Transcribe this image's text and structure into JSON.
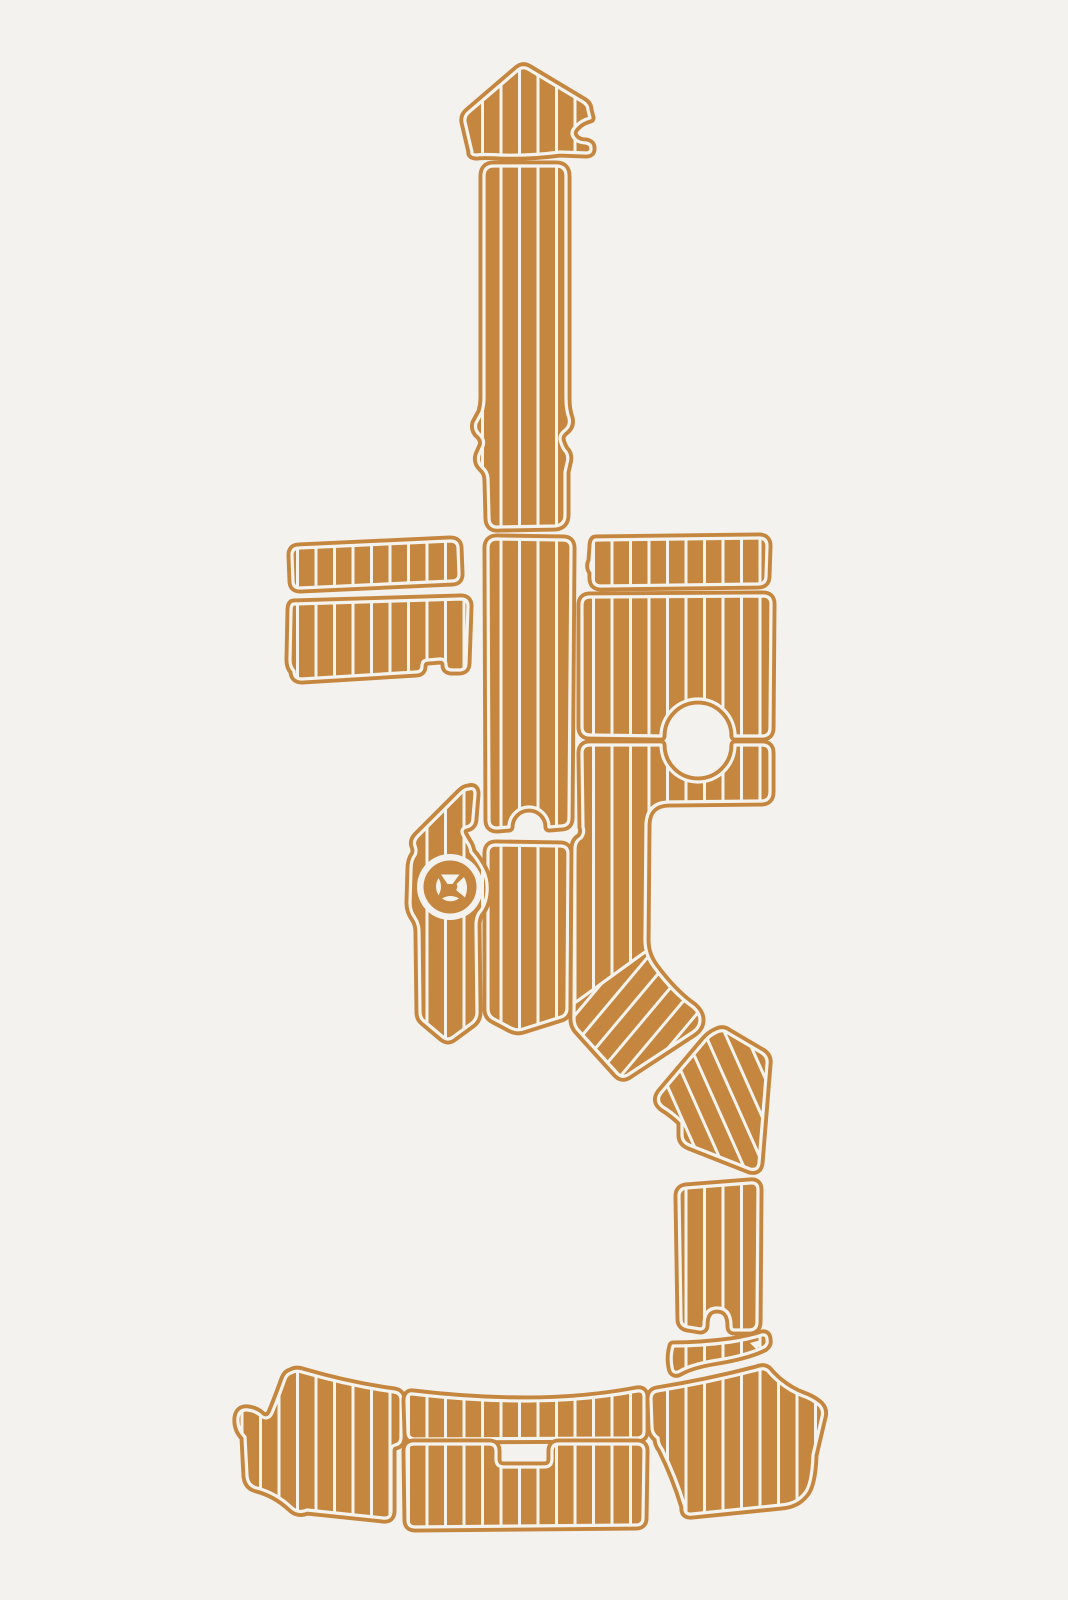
{
  "image": {
    "alt": "EVA foam faux-teak boat decking pad set, full-boat template layout",
    "background_color": "#f3f2ef",
    "pad_color": "#c5873f",
    "seam_color": "#f5f3ee",
    "width": 1068,
    "height": 1600
  },
  "planks": {
    "spacing": 18.5,
    "line_width": 3,
    "edge_margin_stroke": 11,
    "inset_stroke": 3.2,
    "patterns": [
      {
        "id": "planks-v",
        "rotate": 0
      },
      {
        "id": "planks-d24",
        "rotate": -24
      },
      {
        "id": "planks-d40",
        "rotate": 40
      }
    ]
  },
  "pieces": [
    {
      "name": "bow-pad",
      "type": "pad",
      "planks": "planks-v",
      "path": "M 472,152 L 465,122 Q 464,116 469,112 L 518,70 Q 523,66 528,69 L 583,102 Q 588,105 588,110 L 590,118 Q 582,120 577,125 Q 569,132 574,138 Q 578,143 586,143 Q 591,144 591,148 L 591,149 Q 591,153 586,153 L 560,152 Q 530,156 500,155 Q 484,154 477,155 Q 471,155 472,152 Z"
    },
    {
      "name": "bow-walkway",
      "type": "pad",
      "planks": "planks-v",
      "path": "M 494,166 L 556,166 Q 566,166 566,176 L 566,398 Q 566,410 569,418 Q 571,426 564,431 Q 558,436 561,443 Q 563,449 566,452 Q 569,457 567,463 L 565,472 L 565,515 Q 565,525 555,526 L 499,527 Q 489,528 489,518 L 488,480 Q 488,472 482,467 Q 477,462 479,455 L 483,446 Q 485,440 480,435 Q 474,430 476,423 L 482,412 Q 484,405 484,398 L 484,176 Q 484,166 494,166 Z"
    },
    {
      "name": "port-gunwale-strip",
      "type": "pad",
      "planks": "planks-v",
      "path": "M 299,548 L 450,541 Q 458,541 458,548 L 459,574 Q 459,581 452,581 L 300,588 Q 293,588 293,581 L 292,555 Q 292,548 299,548 Z"
    },
    {
      "name": "port-side-pad",
      "type": "pad",
      "planks": "planks-v",
      "path": "M 294,604 L 461,599 Q 468,599 468,606 L 466,663 Q 466,670 459,670 L 452,670 Q 446,670 446,665 Q 446,659 440,659 L 428,660 Q 422,660 422,666 Q 422,672 416,672 L 302,679 Q 294,679 294,671 Q 290,667 290,660 L 291,611 Q 291,604 294,604 Z"
    },
    {
      "name": "cockpit-center-upper",
      "type": "pad",
      "planks": "planks-v",
      "path": "M 497,539 L 563,540 Q 571,540 571,548 L 569,818 Q 569,826 561,826 L 549,827 A 20,20 0 0 0 509,827 L 497,828 Q 489,828 489,820 L 488,548 Q 488,539 497,539 Z"
    },
    {
      "name": "cockpit-center-lower",
      "type": "pad",
      "planks": "planks-v",
      "path": "M 496,845 L 560,846 Q 568,846 568,854 L 567,1008 Q 567,1015 561,1017 L 523,1029 Q 517,1031 511,1028 L 494,1019 Q 488,1016 488,1009 L 488,853 Q 488,845 496,845 Z"
    },
    {
      "name": "helm-wedge-pad",
      "type": "pad",
      "planks": "planks-v",
      "path": "M 469,789 Q 475,787 475,794 L 473,818 Q 473,826 466,827 Q 460,829 463,835 L 467,842 Q 470,846 471,852 Q 478,860 483,870 Q 488,880 487,892 Q 486,905 479,913 Q 476,918 476,925 L 477,1012 Q 477,1019 472,1023 L 453,1037 Q 448,1041 443,1037 L 424,1021 Q 420,1018 420,1012 L 419,932 Q 419,924 415,918 Q 410,911 410,903 L 411,869 Q 411,860 415,855 Q 417,851 415,846 Q 413,841 418,836 L 461,793 Q 465,789 469,789 Z"
    },
    {
      "name": "logo-hole",
      "type": "hole",
      "cx": 450,
      "cy": 887,
      "r": 33
    },
    {
      "name": "logo-disc",
      "type": "disc",
      "cx": 450,
      "cy": 887,
      "r": 24.5,
      "cutouts": [
        "M 441,874.5 L 459.5,874.5 L 452.5,884 L 447.5,884 Z",
        "M 464,877 Q 469.5,887 465,897.5 L 456,890 Q 458.5,887 456.5,884 Z",
        "M 442,898.5 Q 450.5,893.5 459,898.5 Q 450.5,904 442,898.5 Z",
        "M 438.5,878 Q 443.5,886.5 438.5,895.5 Q 433.5,886.5 438.5,878 Z"
      ]
    },
    {
      "name": "starboard-gunwale-strip",
      "type": "pad",
      "planks": "planks-v",
      "path": "M 596,540 L 759,538 Q 767,538 767,546 L 766,576 Q 766,584 758,584 L 601,586 Q 593,586 593,578 L 593,572 Q 589,567 592,561 L 593,547 Q 593,540 596,540 Z"
    },
    {
      "name": "cockpit-starboard-upper",
      "type": "pad",
      "planks": "planks-v",
      "path": "M 590,597 L 763,596 Q 771,596 771,604 L 770,728 Q 770,736 762,736 L 735,736 A 37,37 0 0 0 661,736 L 590,735 Q 582,735 582,727 L 582,605 Q 582,597 590,597 Z"
    },
    {
      "name": "cockpit-starboard-walkway",
      "type": "pad",
      "planks": "planks-v",
      "path": "M 590,745 L 661,745 A 37,37 0 0 0 735,745 L 762,745 Q 770,745 770,753 L 770,792 Q 770,801 761,801 L 668,802 Q 647,803 646,824 L 645,940 Q 645,955 654,967 Q 673,993 693,1007 Q 700,1013 700,1020 Q 700,1027 693,1032 L 629,1074 Q 622,1079 617,1073 L 579,1031 Q 574,1026 574,1019 L 575,849 Q 575,841 581,838 Q 585,833 583,827 L 582,753 Q 582,745 590,745 Z",
      "overlay": {
        "planks": "planks-d40",
        "path": "M 576,1002 L 645,952 Q 649,962 654,967 Q 673,993 693,1007 Q 700,1013 700,1020 Q 700,1027 693,1032 L 629,1074 Q 622,1079 617,1073 L 579,1031 Q 574,1026 574,1019 Z",
        "seam": "M 576,1002 L 645,952"
      }
    },
    {
      "name": "transom-elbow-pad",
      "type": "pad",
      "planks": "planks-d24",
      "path": "M 717,1032 Q 723,1029 728,1033 L 762,1053 Q 768,1057 767,1064 L 759,1163 Q 758,1171 750,1169 L 689,1145 Q 682,1142 682,1135 L 682,1122 Q 673,1113 663,1107 Q 655,1101 661,1093 L 705,1041 Q 710,1035 717,1032 Z"
    },
    {
      "name": "transom-step-pad",
      "type": "pad",
      "planks": "planks-v",
      "path": "M 686,1188 L 750,1183 Q 758,1182 758,1190 L 757,1322 Q 757,1330 749,1330 L 734,1330 Q 731,1330 731,1326 Q 731,1308 717,1308 Q 704,1308 704,1325 Q 704,1329 700,1329 L 688,1327 Q 681,1326 681,1319 L 679,1196 Q 679,1189 686,1188 Z"
    },
    {
      "name": "transom-sliver-pad",
      "type": "pad",
      "planks": "planks-v",
      "path": "M 673,1346 Q 701,1346 731,1342 Q 750,1339 762,1335 Q 767,1334 767,1340 Q 768,1344 764,1347 Q 748,1355 718,1360 Q 692,1364 680,1371 Q 673,1375 672,1367 Q 670,1357 673,1346 Z",
      "details": [
        {
          "path": "M 750,1343 L 761,1340 L 757,1350 Z"
        }
      ]
    },
    {
      "name": "swim-platform-port",
      "type": "pad",
      "planks": "planks-v",
      "path": "M 291,1373 Q 296,1370 302,1372 Q 350,1386 394,1392 Q 401,1393 401,1400 L 401,1437 Q 401,1444 395,1445 Q 391,1446 391,1451 L 391,1511 Q 391,1519 383,1518 L 307,1510 Q 298,1514 291,1507 Q 276,1493 257,1488 Q 248,1486 247,1476 L 245,1437 Q 237,1429 238,1418 Q 239,1409 248,1410 Q 256,1411 261,1416 Q 268,1421 272,1413 Q 279,1396 285,1379 Q 287,1374 291,1373 Z"
    },
    {
      "name": "swim-platform-center",
      "type": "pad",
      "planks": "planks-v",
      "path": "M 413,1394 Q 470,1401 527,1401 Q 584,1401 637,1391 Q 644,1390 644,1397 L 644,1431 Q 644,1438 637,1438 L 415,1439 Q 408,1439 408,1432 L 407,1401 Q 407,1393 413,1394 Z"
    },
    {
      "name": "swim-platform-center-lower",
      "type": "pad",
      "planks": "planks-v",
      "path": "M 414,1444 L 489,1444 Q 496,1444 496,1451 L 496,1459 Q 496,1467 504,1467 L 544,1467 Q 552,1467 552,1459 L 552,1451 Q 552,1444 559,1444 L 637,1444 Q 644,1444 644,1451 L 643,1518 Q 643,1525 636,1525 L 415,1527 Q 408,1527 408,1520 L 407,1451 Q 407,1444 414,1444 Z"
    },
    {
      "name": "swim-platform-starboard",
      "type": "pad",
      "planks": "planks-v",
      "path": "M 657,1391 Q 707,1383 757,1370 Q 764,1367 768,1371 Q 772,1376 779,1382 Q 790,1391 803,1396 Q 812,1399 819,1405 Q 824,1410 822,1417 L 813,1455 Q 812,1486 804,1494 Q 796,1504 781,1505 L 692,1514 Q 684,1515 685,1507 Q 676,1477 662,1449 Q 658,1444 658,1438 Q 652,1434 652,1427 L 651,1399 Q 651,1392 657,1391 Z"
    }
  ]
}
